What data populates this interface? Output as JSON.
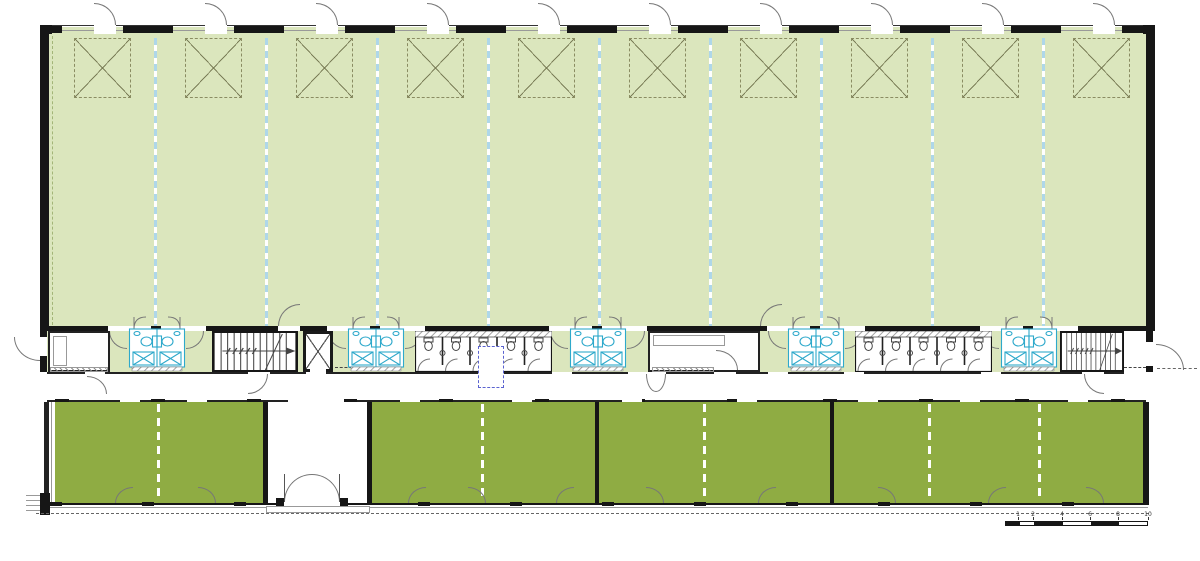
{
  "colors": {
    "hall_fill": "#dbe6bd",
    "room_fill": "#8fac43",
    "fixture_cyan": "#2ea9cb",
    "bay_line_blue": "#aed7e9",
    "wall": "#161616",
    "hatch_gray": "#8c8c8c",
    "shaft_blue": "#5b63d0",
    "skylight_line": "#7b7e58",
    "door_arc_gray": "#777777",
    "overhang_gray": "#666666"
  },
  "scale_bar": {
    "labels": [
      "1",
      "2",
      "4",
      "6",
      "8",
      "10"
    ]
  }
}
